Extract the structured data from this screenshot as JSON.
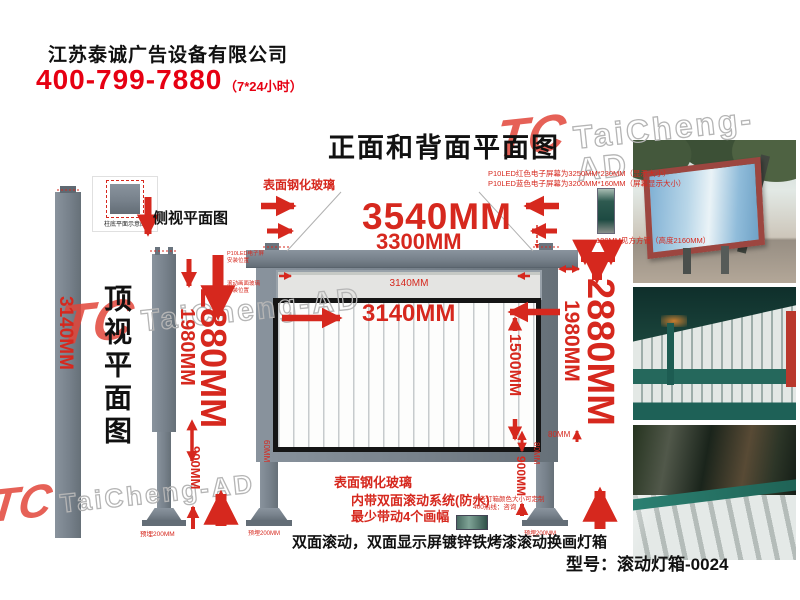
{
  "colors": {
    "accent_red": "#d6281e",
    "brand_red": "#e60012",
    "frame_gray": "#77818b",
    "watermark_gray": "#b5b5b5",
    "teal": "#2a7d6e"
  },
  "header": {
    "company": "江苏泰诚广告设备有限公司",
    "phone": "400-799-7880",
    "hours": "（7*24小时）"
  },
  "title": "正面和背面平面图",
  "watermark": {
    "logo": "TC",
    "text": "TaiCheng-AD"
  },
  "top_view": {
    "label": "顶视平面图",
    "bar_dim": "3140MM",
    "inset_caption": "柱底平面示意图"
  },
  "side_view": {
    "label": "侧视平面图",
    "total_height": "2880MM",
    "frame_height": "1980MM",
    "pole_height": "900MM",
    "base_note": "预埋200MM",
    "anno_led_line1": "P10LED电子屏",
    "anno_led_line2": "安装位置",
    "anno_screen_line1": "滚动画面玻璃",
    "anno_screen_line2": "安装位置"
  },
  "front_view": {
    "glass_note": "表面钢化玻璃",
    "led_note1": "P10LED红色电子屏幕为3250MM*230MM（显示大小）",
    "led_note2": "P10LED蓝色电子屏幕为3200MM*160MM（屏幕显示大小）",
    "width_total": "3540MM",
    "width_frame": "3300MM",
    "tube_note": "120MM见方方管（高度2160MM）",
    "led_strip_dim": "3140MM",
    "screen_width": "3140MM",
    "screen_height": "1500MM",
    "total_height": "2880MM",
    "frame_height": "1980MM",
    "pole_height": "900MM",
    "edge_left": "60MM",
    "edge_right": "80MM",
    "edge_top": "80MM",
    "base_note_left": "预埋200MM",
    "base_note_right": "预埋200MM"
  },
  "notes": {
    "glass": "表面钢化玻璃",
    "system1": "内带双面滚动系统(防水)",
    "system2": "最少带动4个画幅",
    "custom1": "广告灯箱颜色大小可定制",
    "custom2": "400热线：咨询",
    "caption": "双面滚动，双面显示屏镀锌铁烤漆滚动换画灯箱",
    "model_label": "型号：滚动灯箱-0024"
  }
}
